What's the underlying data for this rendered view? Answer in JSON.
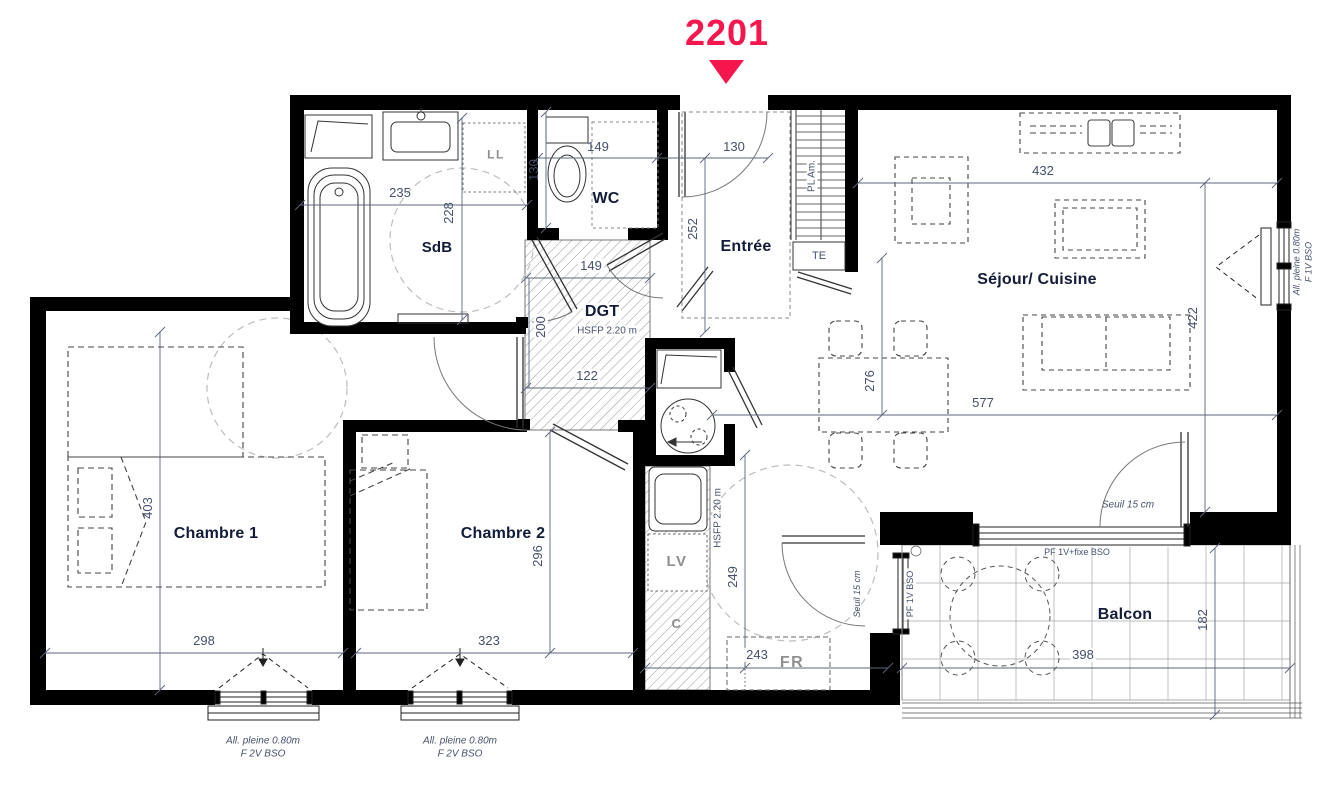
{
  "title": {
    "number": "2201"
  },
  "colors": {
    "accent": "#F5164D",
    "wall": "#000000",
    "dim_text": "#45506A",
    "room_text": "#121C38"
  },
  "rooms": {
    "sdb": "SdB",
    "wc": "WC",
    "entree": "Entrée",
    "dgt": "DGT",
    "sejour": "Séjour/ Cuisine",
    "chambre1": "Chambre 1",
    "chambre2": "Chambre 2",
    "balcon": "Balcon"
  },
  "notes": {
    "dgt_hsfp": "HSFP 2.20 m",
    "cuisine_hsfp": "HSFP 2.20 m"
  },
  "dimensions": {
    "sdb_w": "235",
    "sdb_h": "228",
    "wc_w": "149",
    "wc_h": "130",
    "entree_w": "130",
    "entree_h": "252",
    "sejour_top": "432",
    "sejour_right": "422",
    "sejour_len": "577",
    "dining_h": "276",
    "dgt_top": "149",
    "dgt_left": "200",
    "dgt_bottom": "122",
    "ch1_h": "403",
    "ch1_w": "298",
    "ch2_h": "296",
    "ch2_w": "323",
    "kitchen_h": "249",
    "kitchen_w": "243",
    "balcon_h": "182",
    "balcon_w": "398"
  },
  "annotations": {
    "seuil_sejour": "Seuil 15 cm",
    "seuil_cuisine": "Seuil 15 cm",
    "pf_fixe": "PF 1V+fixe BSO",
    "pf_balcon": "PF 1V BSO",
    "all_right_1": "All. pleine 0.80m",
    "all_right_2": "F 1V BSO",
    "all_bottom_1": "All. pleine 0.80m",
    "all_bottom_2": "F 2V BSO",
    "placard": "PL Am.",
    "te": "TE"
  },
  "appliances": {
    "ll": "LL",
    "lv": "LV",
    "fr": "FR",
    "c": "C"
  }
}
